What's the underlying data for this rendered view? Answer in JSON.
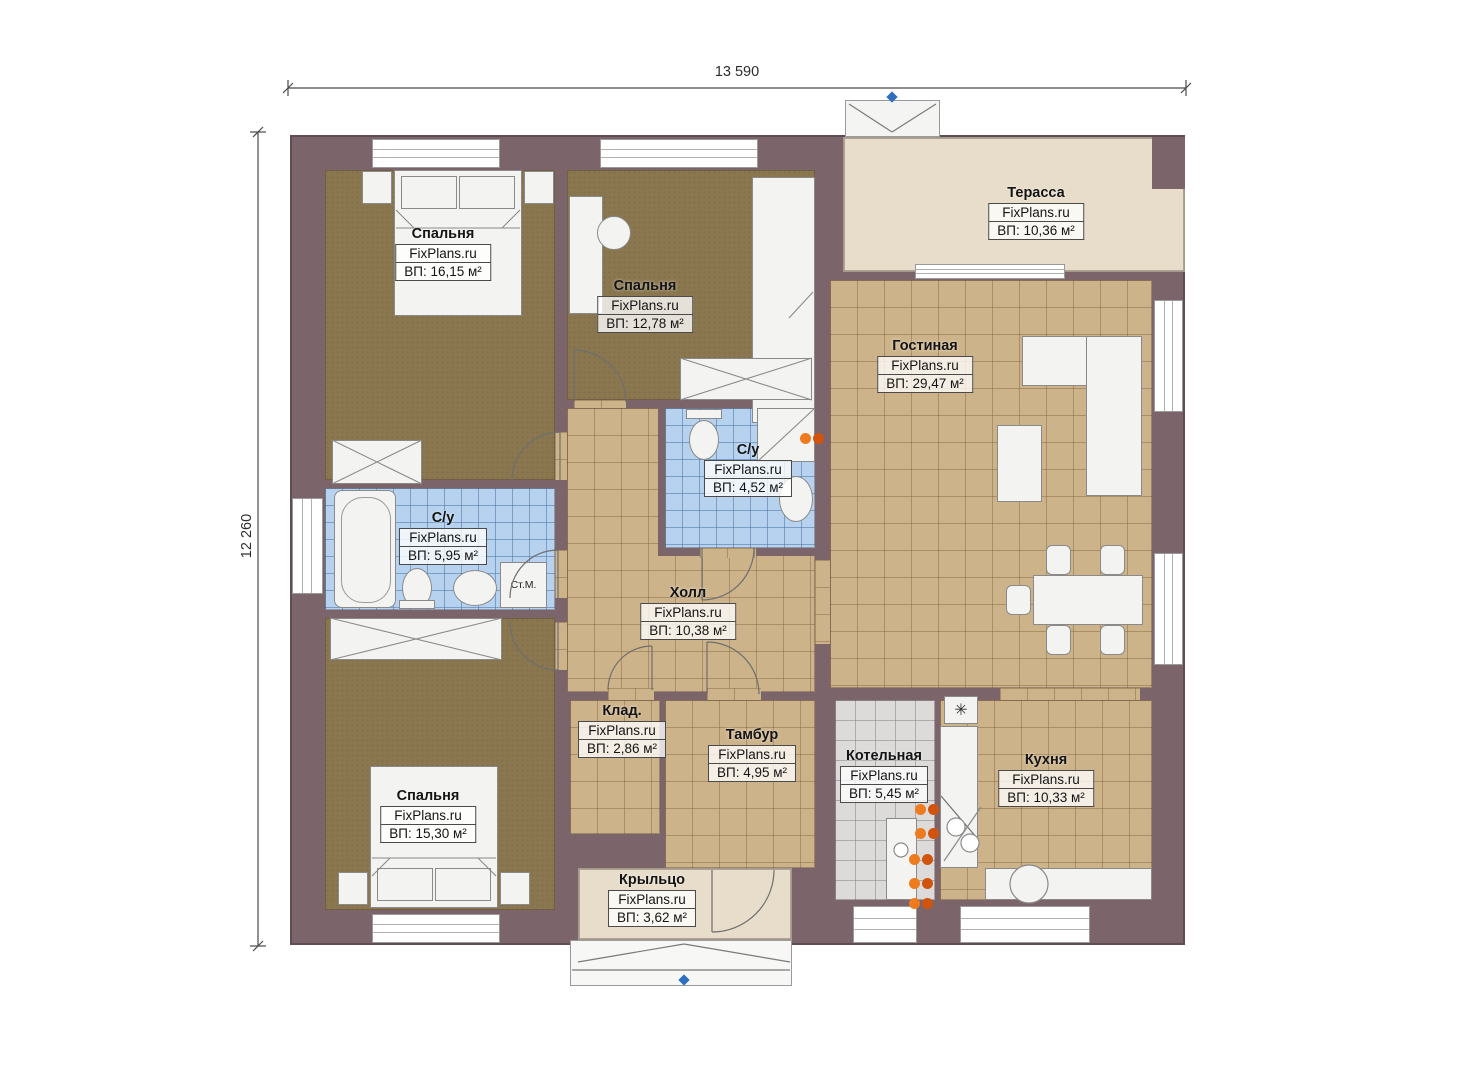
{
  "plan_title": "Floor plan",
  "brand": "FixPlans.ru",
  "dimensions": {
    "top": "13 590",
    "left": "12 260"
  },
  "rooms": [
    {
      "key": "bedroom-1",
      "name": "Спальня",
      "brand": "FixPlans.ru",
      "area": "ВП: 16,15 м²"
    },
    {
      "key": "bedroom-2",
      "name": "Спальня",
      "brand": "FixPlans.ru",
      "area": "ВП: 12,78 м²"
    },
    {
      "key": "terrace",
      "name": "Терасса",
      "brand": "FixPlans.ru",
      "area": "ВП: 10,36 м²"
    },
    {
      "key": "living",
      "name": "Гостиная",
      "brand": "FixPlans.ru",
      "area": "ВП: 29,47 м²"
    },
    {
      "key": "bath-center",
      "name": "С/у",
      "brand": "FixPlans.ru",
      "area": "ВП: 4,52 м²"
    },
    {
      "key": "bath-left",
      "name": "С/у",
      "brand": "FixPlans.ru",
      "area": "ВП: 5,95 м²"
    },
    {
      "key": "hall",
      "name": "Холл",
      "brand": "FixPlans.ru",
      "area": "ВП: 10,38 м²"
    },
    {
      "key": "storage",
      "name": "Клад.",
      "brand": "FixPlans.ru",
      "area": "ВП: 2,86 м²"
    },
    {
      "key": "tambour",
      "name": "Тамбур",
      "brand": "FixPlans.ru",
      "area": "ВП: 4,95 м²"
    },
    {
      "key": "boiler",
      "name": "Котельная",
      "brand": "FixPlans.ru",
      "area": "ВП: 5,45 м²"
    },
    {
      "key": "kitchen",
      "name": "Кухня",
      "brand": "FixPlans.ru",
      "area": "ВП: 10,33 м²"
    },
    {
      "key": "bedroom-3",
      "name": "Спальня",
      "brand": "FixPlans.ru",
      "area": "ВП: 15,30 м²"
    },
    {
      "key": "porch",
      "name": "Крыльцо",
      "brand": "FixPlans.ru",
      "area": "ВП: 3,62 м²"
    }
  ],
  "annotations": {
    "washing_machine": "Ст.М.",
    "vent_symbol": "✳"
  },
  "palette": {
    "wall": "#7b656b",
    "tile_floor": "#cdb38a",
    "wood_floor": "#8a774f",
    "bath_tile": "#b6d2ee",
    "utility_tile": "#dcdbda",
    "deck": "#e8ddca",
    "radiator": "#e86a1c",
    "marker_blue": "#2f6fbe"
  }
}
